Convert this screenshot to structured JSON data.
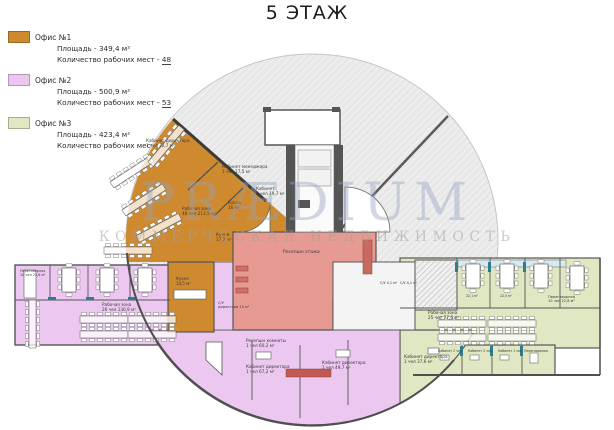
{
  "title": "5 ЭТАЖ",
  "watermark": {
    "brand": "PRÆDIUM",
    "subtitle": "КОММЕРЧЕСКАЯ НЕДВИЖИМОСТЬ"
  },
  "legend": {
    "items": [
      {
        "name": "Офис №1",
        "color": "#cf8a30",
        "area_label": "Площадь - 349,4 м²",
        "workplaces_label": "Количество рабочих мест - ",
        "workplaces_value": "48"
      },
      {
        "name": "Офис №2",
        "color": "#ecc8f0",
        "area_label": "Площадь - 500,9 м²",
        "workplaces_label": "Количество рабочих мест - ",
        "workplaces_value": "53"
      },
      {
        "name": "Офис №3",
        "color": "#dfe7c3",
        "area_label": "Площадь - 423,4 м²",
        "workplaces_label": "Количество рабочих мест - ",
        "workplaces_value": "52"
      }
    ]
  },
  "plan": {
    "colors": {
      "office1": "#cf8a30",
      "office2": "#ecc8f0",
      "office3": "#dfe7c3",
      "reception": "#e69a92",
      "walls": "#4f4f4f",
      "accent_teal": "#2d7d8e",
      "service": "#f4f4f4",
      "watermark_blue": "#92a2bd"
    },
    "rooms": {
      "reception_floor": "Ресепшн этажа",
      "reception_rooms": {
        "l1": "Ресепшн комнаты",
        "l2": "1 чел  60,2 м²"
      },
      "work_zone_or": {
        "l1": "Рабочая зона",
        "l2": "48 чел  213,5 м²"
      },
      "dir_or": {
        "l1": "Кабинет директора",
        "l2": "1 чел  32,7 м²"
      },
      "mgr_or": {
        "l1": "Кабинет менеджера",
        "l2": "1 чел  17,5 м²"
      },
      "kab_or": {
        "l1": "Кабинет",
        "l2": "2 чел  19,7 м²"
      },
      "kassa": {
        "l1": "Касса",
        "l2": "16 м²"
      },
      "kitchen_or": {
        "l1": "Кухня",
        "l2": "17,2 м²"
      },
      "pereg_p": {
        "l1": "Переговорная",
        "l2": "10 чел  23,6 м²"
      },
      "work_zone_p": {
        "l1": "Рабочая зона",
        "l2": "26 чел  130,9 м²"
      },
      "kitchen_p": {
        "l1": "Кухня",
        "l2": "14,5 м²"
      },
      "su_dir": {
        "l1": "С/У",
        "l2": "директора 10 м²"
      },
      "dir_p1": {
        "l1": "Кабинет директора",
        "l2": "1 чел  67,2 м²"
      },
      "dir_p2": {
        "l1": "Кабинет директора",
        "l2": "1 чел  49,7 м²"
      },
      "dir_g": {
        "l1": "Кабинет директора",
        "l2": "1 чел  37,6 м²"
      },
      "work_zone_g": {
        "l1": "Рабочая зона",
        "l2": "25 чел  77,6 м²"
      },
      "pereg_g": {
        "l1": "Переговорная",
        "l2": "10 чел  22,8 м²"
      },
      "su": "С/У 4,1 м²",
      "kab_g1": "Кабинет 2 чел",
      "kab_g2": "Кабинет 2 чел",
      "kab_g3": "Кабинет 1 чел",
      "pereg_g2": "Переговорная",
      "area_g1": "22,1 м²",
      "area_g2": "22,5 м²"
    }
  }
}
